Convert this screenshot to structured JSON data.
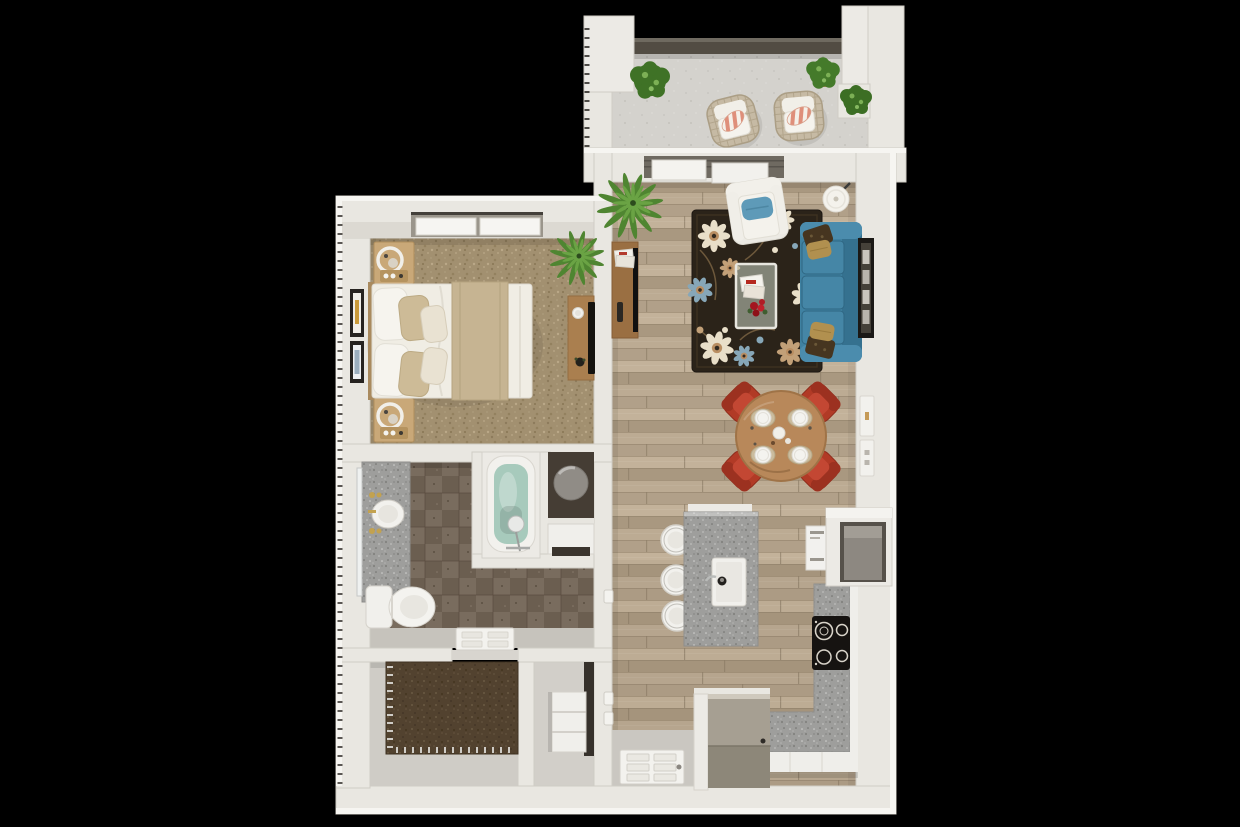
{
  "scene": {
    "title": "3D top-down floor plan rendering of a one-bedroom apartment",
    "view": {
      "width": 1240,
      "height": 827,
      "background": "#000000"
    },
    "rooms": [
      {
        "name": "balcony",
        "floor": "concrete",
        "items": [
          "wicker lounge chair",
          "wicker lounge chair",
          "coral striped pillows",
          "boxwood shrub",
          "boxwood shrub",
          "boxwood shrub",
          "glass railing"
        ]
      },
      {
        "name": "living-room",
        "floor": "hardwood plank",
        "items": [
          "teal three-seat sofa",
          "gold accent pillows",
          "dark fringe pillows",
          "white accent chair with blue pillow",
          "glass coffee table",
          "red rose centerpiece",
          "magazines",
          "dark floral area rug",
          "wood media console",
          "flat tv",
          "remote control",
          "white drum floor lamp",
          "framed wall art",
          "potted palm",
          "sliding glass balcony door"
        ]
      },
      {
        "name": "dining-area",
        "floor": "hardwood plank",
        "items": [
          "round wood dining table",
          "red upholstered chair",
          "red upholstered chair",
          "red upholstered chair",
          "red upholstered chair",
          "four place settings with plates and placemats",
          "teapot centerpiece",
          "thermostat panel",
          "light switch panel"
        ]
      },
      {
        "name": "kitchen",
        "floor": "hardwood plank",
        "items": [
          "granite island with sink and faucet",
          "white bar stool",
          "white bar stool",
          "white bar stool",
          "granite L-shaped counter",
          "black four-burner cooktop",
          "built-in wall oven panel",
          "tall pantry cabinet",
          "refrigerator",
          "white lower cabinets"
        ]
      },
      {
        "name": "bedroom",
        "floor": "tan carpet",
        "items": [
          "queen bed with white duvet and tan throw",
          "white pillows",
          "tan pillows",
          "nightstand with ring lamp",
          "nightstand with ring lamp",
          "framed wall art",
          "framed wall art",
          "wood dresser desk",
          "flat tv",
          "potted palm",
          "window"
        ]
      },
      {
        "name": "bathroom",
        "floor": "dark brown tile",
        "items": [
          "granite vanity with round sink",
          "brass fixtures",
          "mirror",
          "toilet",
          "soaking tub with water",
          "handheld shower faucet",
          "water-heater closet",
          "linen cabinet",
          "open door leaf"
        ]
      },
      {
        "name": "walk-in-closet",
        "floor": "gray with dark brown carpet inset",
        "items": [
          "hanger rails"
        ]
      },
      {
        "name": "laundry-nook",
        "floor": "gray",
        "items": [
          "white shelf cabinet"
        ]
      },
      {
        "name": "entry",
        "floor": "gray",
        "items": [
          "open front door leaf with six panels and knob"
        ]
      }
    ]
  },
  "palette": {
    "background": "#000000",
    "wall": "#e9e7e1",
    "wall_bright": "#f6f5f1",
    "wall_shadow": "#cfccc5",
    "railing": "#524c43",
    "wood_floor": "#b4a38b",
    "concrete": "#d4d2cd",
    "carpet_bedroom": "#a29070",
    "carpet_closet": "#52422f",
    "tile_dark": "#6b5e50",
    "tile_light": "#796c5e",
    "granite": "#9e9e9c",
    "sofa_teal": "#3f81a1",
    "sofa_cushion": "#4586a6",
    "pillow_gold": "#b1904f",
    "pillow_dark": "#463520",
    "pillow_stripe_coral": "#df8f7a",
    "dining_chair_red": "#b13a26",
    "wood_table": "#b8885a",
    "wood_console": "#9a6f42",
    "rug_base": "#2b2319",
    "rug_cream": "#e9dfc9",
    "rug_blue": "#87a7b8",
    "rug_tan": "#c2a078",
    "tub_water": "#a7cabc",
    "plant_green": "#4f8531",
    "plant_light": "#6aa344",
    "appliance_gray": "#8d8779",
    "cooktop_black": "#161311",
    "white_goods": "#f2f1ed",
    "door_white": "#f3f2ee",
    "brass": "#c3a24f",
    "hall_gray": "#c6c3bc",
    "entry_gray": "#cac7c1"
  }
}
